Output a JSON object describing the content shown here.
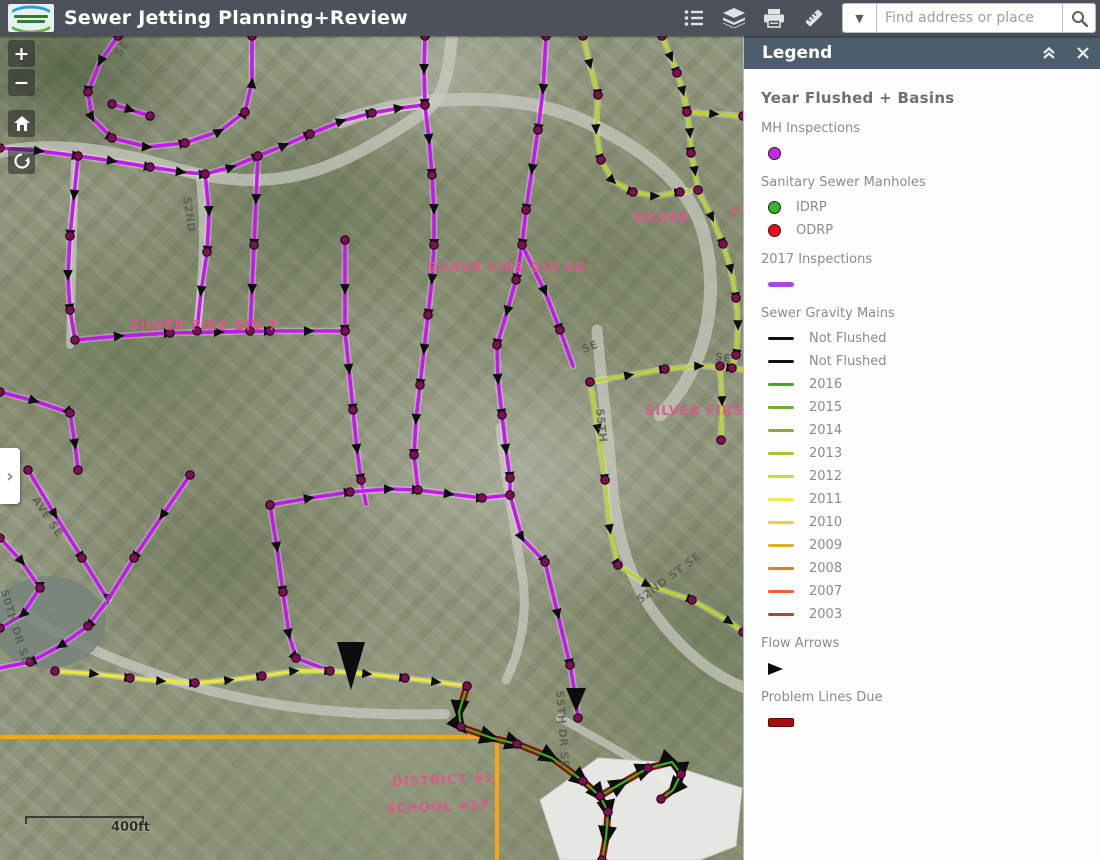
{
  "header": {
    "title": "Sewer Jetting Planning+Review",
    "logo_name": "Silver Lake Water & Sewer District",
    "tools": {
      "legend_tooltip": "Legend",
      "layers_tooltip": "Layer List",
      "print_tooltip": "Print",
      "measure_tooltip": "Measurement"
    },
    "search": {
      "placeholder": "Find address or place"
    }
  },
  "map_controls": {
    "zoom_in": "+",
    "zoom_out": "−",
    "home_tooltip": "Default extent",
    "locate_tooltip": "My location",
    "expand": "›"
  },
  "legend": {
    "title": "Legend",
    "section_title": "Year Flushed + Basins",
    "groups": [
      {
        "label": "MH Inspections",
        "items": [
          {
            "swatch": "circle",
            "color": "#c32ae0",
            "label": ""
          }
        ]
      },
      {
        "label": "Sanitary Sewer Manholes",
        "items": [
          {
            "swatch": "circle",
            "color": "#39b32a",
            "label": "IDRP"
          },
          {
            "swatch": "circle",
            "color": "#f50514",
            "label": "ODRP"
          }
        ]
      },
      {
        "label": "2017 Inspections",
        "items": [
          {
            "swatch": "line-thick",
            "color": "#ab47e8",
            "label": ""
          }
        ]
      },
      {
        "label": "Sewer Gravity Mains",
        "items": [
          {
            "swatch": "line",
            "color": "#111111",
            "label": "Not Flushed"
          },
          {
            "swatch": "line",
            "color": "#111111",
            "label": "Not Flushed"
          },
          {
            "swatch": "line",
            "color": "#4f9e2e",
            "label": "2016"
          },
          {
            "swatch": "line",
            "color": "#6ab32b",
            "label": "2015"
          },
          {
            "swatch": "line",
            "color": "#8aab2d",
            "label": "2014"
          },
          {
            "swatch": "line",
            "color": "#a9c52d",
            "label": "2013"
          },
          {
            "swatch": "line",
            "color": "#cbd936",
            "label": "2012"
          },
          {
            "swatch": "line",
            "color": "#f0ee45",
            "label": "2011"
          },
          {
            "swatch": "line",
            "color": "#edd32e",
            "label": "2010"
          },
          {
            "swatch": "line",
            "color": "#e9ab26",
            "label": "2009"
          },
          {
            "swatch": "line",
            "color": "#c9862d",
            "label": "2008"
          },
          {
            "swatch": "line",
            "color": "#ee5f2b",
            "label": "2007"
          },
          {
            "swatch": "line",
            "color": "#b0452e",
            "label": "2003"
          }
        ]
      },
      {
        "label": "Flow Arrows",
        "items": [
          {
            "swatch": "arrow",
            "color": "#0a0a0a",
            "label": ""
          }
        ]
      },
      {
        "label": "Problem Lines Due",
        "items": [
          {
            "swatch": "block",
            "color": "#a80d12",
            "label": ""
          }
        ]
      }
    ]
  },
  "map": {
    "scale_text": "400ft",
    "overlay_colors": {
      "inspections_2017": "#c617f2",
      "flushed_greens": "#b9d32f",
      "flushed_yellow": "#e8e838",
      "problem_lines": "#a80d12",
      "district_boundary": "#f5a51d",
      "manhole_node": "#7c1150"
    },
    "area_labels": [
      {
        "text": "SILVER FIRS DIV 7",
        "x": 130,
        "y": 319,
        "rot": 0
      },
      {
        "text": "SILVER FIRS DIV 6B",
        "x": 427,
        "y": 261,
        "rot": 0
      },
      {
        "text": "SILVER",
        "x": 634,
        "y": 211,
        "rot": 0
      },
      {
        "text": "FI",
        "x": 730,
        "y": 205,
        "rot": 0
      },
      {
        "text": "SILVER FIRS D",
        "x": 645,
        "y": 404,
        "rot": 0
      },
      {
        "text": "DISTRICT #2",
        "x": 392,
        "y": 775,
        "rot": -2
      },
      {
        "text": "SCHOOL #17",
        "x": 386,
        "y": 802,
        "rot": -2
      }
    ],
    "street_labels": [
      {
        "text": "SE",
        "x": 112,
        "y": 52,
        "rot": -58
      },
      {
        "text": "52ND",
        "x": 193,
        "y": 196,
        "rot": 82
      },
      {
        "text": "55TH",
        "x": 606,
        "y": 408,
        "rot": 84
      },
      {
        "text": "SE",
        "x": 716,
        "y": 350,
        "rot": 10
      },
      {
        "text": "SE",
        "x": 580,
        "y": 344,
        "rot": -22
      },
      {
        "text": "52ND ST SE",
        "x": 634,
        "y": 596,
        "rot": -37
      },
      {
        "text": "50TH DR SE",
        "x": 10,
        "y": 588,
        "rot": 73
      },
      {
        "text": "55TH DR SE",
        "x": 566,
        "y": 690,
        "rot": 86
      },
      {
        "text": "AVE SE",
        "x": 40,
        "y": 494,
        "rot": 56
      }
    ]
  }
}
